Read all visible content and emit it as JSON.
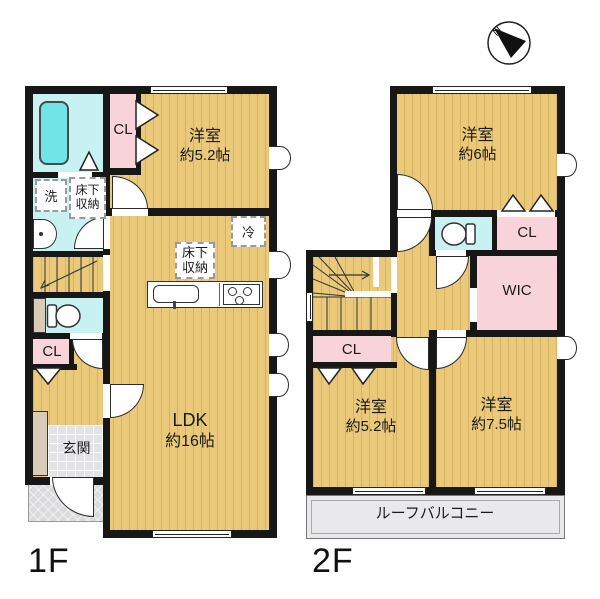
{
  "compass": {
    "n": "N"
  },
  "colors": {
    "floor_tan": "#EAC97A",
    "wet_cyan": "#C8F2F2",
    "closet_pink": "#F8D4DA",
    "tub_cyan": "#70E5E7",
    "balcony_gray": "#E9E9EC",
    "wall_black": "#171717"
  },
  "floor1": {
    "label": "1F",
    "room52": {
      "name": "洋室",
      "size": "約5.2帖"
    },
    "ldk": {
      "name": "LDK",
      "size": "約16帖"
    },
    "cl_top": "CL",
    "cl_hall": "CL",
    "laundry": "洗",
    "underfloor_wash": {
      "line1": "床下",
      "line2": "収納"
    },
    "underfloor_kitchen": {
      "line1": "床下",
      "line2": "収納"
    },
    "fridge": "冷",
    "genkan": "玄関"
  },
  "floor2": {
    "label": "2F",
    "room6": {
      "name": "洋室",
      "size": "約6帖"
    },
    "cl_right": "CL",
    "wic": "WIC",
    "cl_left": "CL",
    "room52": {
      "name": "洋室",
      "size": "約5.2帖"
    },
    "room75": {
      "name": "洋室",
      "size": "約7.5帖"
    },
    "balcony": "ルーフバルコニー"
  }
}
